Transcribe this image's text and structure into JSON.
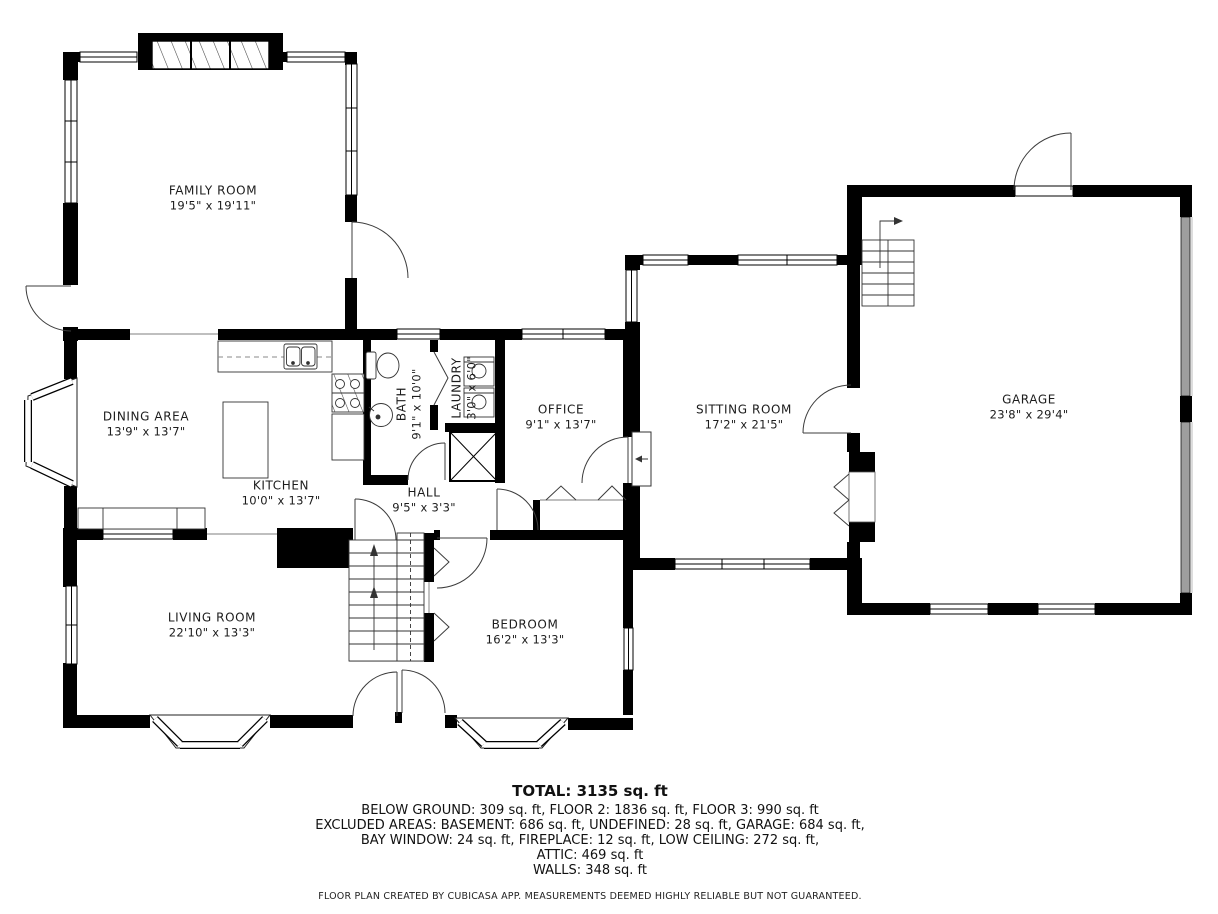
{
  "plan": {
    "rooms": [
      {
        "id": "family-room",
        "name": "FAMILY ROOM",
        "dims": "19'5\" x 19'11\""
      },
      {
        "id": "dining-area",
        "name": "DINING AREA",
        "dims": "13'9\" x 13'7\""
      },
      {
        "id": "kitchen",
        "name": "KITCHEN",
        "dims": "10'0\" x 13'7\""
      },
      {
        "id": "bath",
        "name": "BATH",
        "dims": "9'1\" x 10'0\""
      },
      {
        "id": "laundry",
        "name": "LAUNDRY",
        "dims": "3'0\" x 6'0\""
      },
      {
        "id": "office",
        "name": "OFFICE",
        "dims": "9'1\" x 13'7\""
      },
      {
        "id": "sitting-room",
        "name": "SITTING ROOM",
        "dims": "17'2\" x 21'5\""
      },
      {
        "id": "garage",
        "name": "GARAGE",
        "dims": "23'8\" x 29'4\""
      },
      {
        "id": "hall",
        "name": "HALL",
        "dims": "9'5\" x 3'3\""
      },
      {
        "id": "living-room",
        "name": "LIVING ROOM",
        "dims": "22'10\" x 13'3\""
      },
      {
        "id": "bedroom",
        "name": "BEDROOM",
        "dims": "16'2\" x 13'3\""
      }
    ],
    "summary": {
      "total": "TOTAL: 3135 sq. ft",
      "line1": "BELOW GROUND: 309 sq. ft, FLOOR 2: 1836 sq. ft, FLOOR 3: 990 sq. ft",
      "line2": "EXCLUDED AREAS: BASEMENT: 686 sq. ft, UNDEFINED: 28 sq. ft, GARAGE: 684 sq. ft,",
      "line3": "BAY WINDOW: 24 sq. ft, FIREPLACE: 12 sq. ft, LOW CEILING: 272 sq. ft,",
      "line4": "ATTIC: 469 sq. ft",
      "line5": "WALLS: 348 sq. ft",
      "disclaimer": "FLOOR PLAN CREATED BY CUBICASA APP. MEASUREMENTS DEEMED HIGHLY RELIABLE BUT NOT GUARANTEED."
    },
    "colors": {
      "wall": "#000000",
      "floor": "#ffffff",
      "garage_door_band": "#9e9e9e",
      "text": "#1c1c1c"
    }
  }
}
